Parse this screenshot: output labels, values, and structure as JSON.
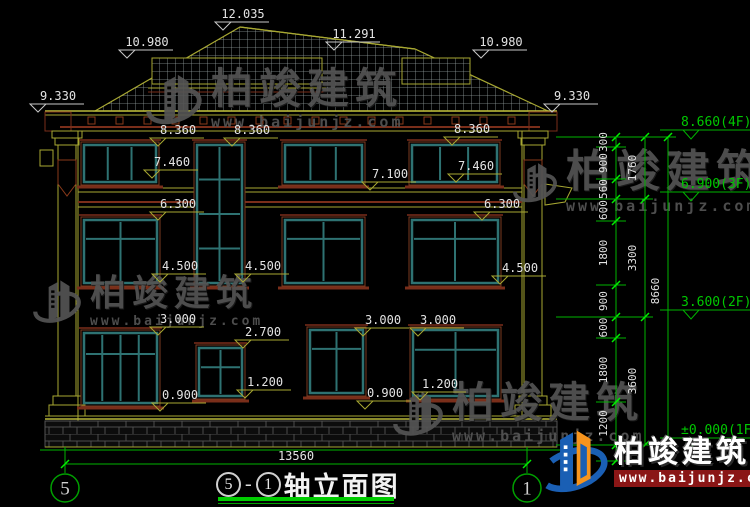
{
  "watermark": {
    "brand": "柏竣建筑",
    "url": "www.baijunjz.com"
  },
  "title": {
    "axis_left": "5",
    "dash": "-",
    "axis_right": "1",
    "name": "轴立面图"
  },
  "axis_bubbles": {
    "left": "5",
    "right": "1"
  },
  "total_width_dim": "13560",
  "roof_markers": [
    "10.980",
    "12.035",
    "11.291",
    "10.980",
    "9.330",
    "9.330"
  ],
  "facade_markers": [
    "8.360",
    "8.360",
    "8.360",
    "7.460",
    "7.460",
    "7.100",
    "6.300",
    "6.300",
    "4.500",
    "4.500",
    "4.500",
    "3.000",
    "3.000",
    "3.000",
    "2.700",
    "1.200",
    "1.200",
    "0.900",
    "0.900"
  ],
  "right_dimensions": {
    "chain_inner": [
      "300",
      "900",
      "560",
      "600",
      "1800",
      "900",
      "600",
      "1800",
      "1200",
      "450"
    ],
    "chain_mid": [
      "1760",
      "3300",
      "3600"
    ],
    "chain_outer": [
      "8660"
    ],
    "levels": [
      "8.660(4F)",
      "6.900(3F)",
      "3.600(2F)",
      "±0.000(1F)"
    ]
  },
  "colors": {
    "dim_green": "#00b400",
    "tick_green": "#00ee00",
    "label_green": "#00c800",
    "olive": "#a8a832",
    "maroon": "#7a2e1a",
    "teal": "#2e7272",
    "dim_text": "#e3e3e3",
    "brand_blue": "#1a5fb4",
    "brand_orange": "#f7941d",
    "url_red": "#8a1616"
  }
}
